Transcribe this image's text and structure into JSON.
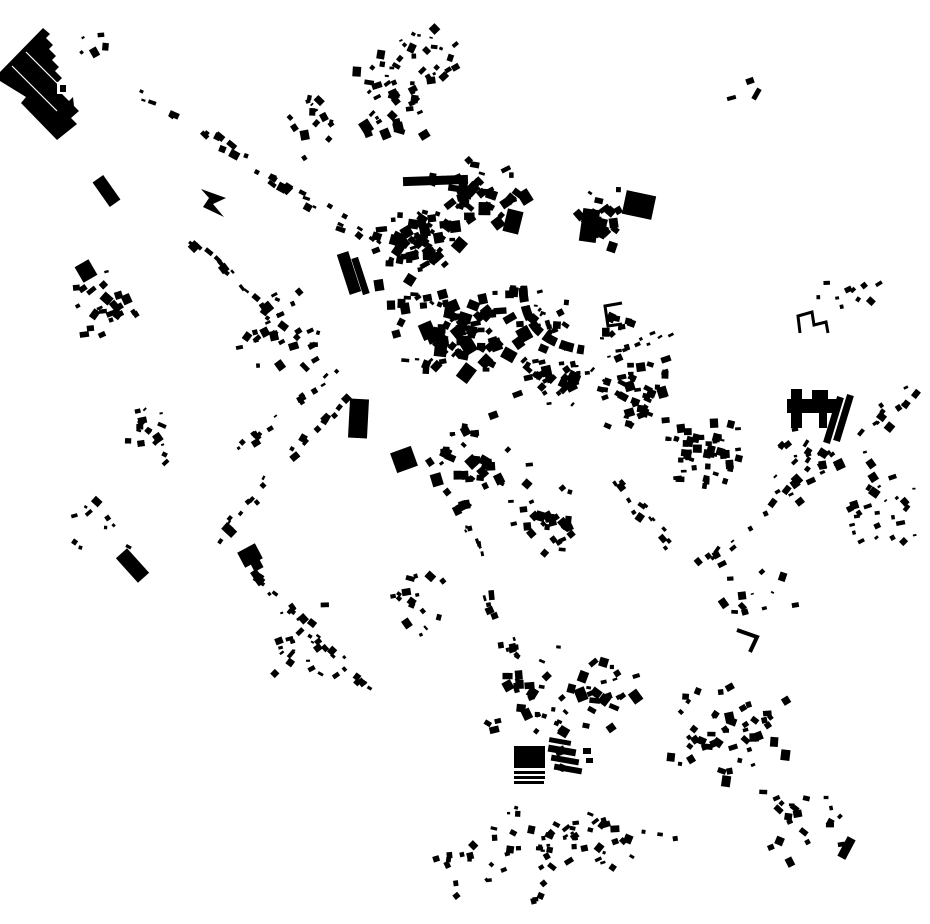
{
  "canvas": {
    "width": 930,
    "height": 924,
    "background": "#ffffff",
    "ink": "#000000"
  },
  "map": {
    "seed": 1337,
    "landmarks": {
      "factory": {
        "polygon": [
          [
            43,
            28
          ],
          [
            50,
            34
          ],
          [
            46,
            38
          ],
          [
            53,
            45
          ],
          [
            49,
            49
          ],
          [
            56,
            56
          ],
          [
            52,
            60
          ],
          [
            59,
            67
          ],
          [
            55,
            71
          ],
          [
            62,
            78
          ],
          [
            58,
            82
          ],
          [
            65,
            89
          ],
          [
            61,
            93
          ],
          [
            69,
            101
          ],
          [
            73,
            97
          ],
          [
            74,
            106
          ],
          [
            79,
            111
          ],
          [
            71,
            118
          ],
          [
            77,
            124
          ],
          [
            57,
            140
          ],
          [
            21,
            103
          ],
          [
            26,
            97
          ],
          [
            13,
            89
          ],
          [
            0,
            81
          ],
          [
            0,
            72
          ]
        ],
        "roof_lines": [
          [
            12,
            66,
            57,
            111
          ],
          [
            26,
            52,
            71,
            97
          ]
        ],
        "notch_white": [
          57,
          82,
          11,
          12
        ],
        "notch_black": [
          60,
          85,
          6,
          7
        ]
      },
      "arrow": [
        [
          201,
          189
        ],
        [
          226,
          198
        ],
        [
          213,
          204
        ],
        [
          224,
          217
        ],
        [
          203,
          207
        ],
        [
          209,
          198
        ]
      ],
      "crescent": {
        "path": "M 523 288 C 524 316 534 334 560 344 C 568 347 576 349 584 350",
        "stroke_width": 9,
        "dash": "14 4"
      },
      "h_complex": [
        [
          787,
          399,
          51,
          14,
          0
        ],
        [
          791,
          389,
          11,
          39,
          0
        ],
        [
          812,
          390,
          16,
          11,
          0
        ],
        [
          819,
          411,
          8,
          17,
          0
        ],
        [
          830,
          396,
          7,
          48,
          17
        ],
        [
          840,
          394,
          7,
          48,
          17
        ]
      ],
      "farm_block": [
        [
          514,
          746,
          31,
          22,
          0
        ],
        [
          514,
          771,
          31,
          3,
          0
        ],
        [
          514,
          776,
          31,
          3,
          0
        ],
        [
          514,
          781,
          30,
          3,
          0
        ],
        [
          548,
          747,
          28,
          7,
          10
        ],
        [
          551,
          757,
          28,
          6,
          10
        ],
        [
          554,
          766,
          28,
          6,
          10
        ],
        [
          549,
          739,
          22,
          5,
          10
        ],
        [
          583,
          748,
          8,
          6,
          0
        ],
        [
          586,
          758,
          7,
          5,
          0
        ]
      ],
      "brackets": [
        {
          "points": [
            [
              622,
              303
            ],
            [
              605,
              306
            ],
            [
              608,
              326
            ],
            [
              622,
              324
            ]
          ],
          "width": 3
        },
        {
          "points": [
            [
              800,
              333
            ],
            [
              798,
              316
            ],
            [
              812,
              312
            ],
            [
              814,
              325
            ],
            [
              826,
              322
            ],
            [
              828,
              333
            ]
          ],
          "width": 3
        },
        {
          "points": [
            [
              737,
              630
            ],
            [
              757,
              637
            ],
            [
              750,
              652
            ]
          ],
          "width": 4
        }
      ],
      "bars": [
        [
          403,
          176,
          65,
          9,
          -2
        ],
        [
          459,
          180,
          9,
          27,
          -2
        ],
        [
          343,
          252,
          12,
          42,
          -18
        ],
        [
          357,
          257,
          7,
          38,
          -18
        ],
        [
          349,
          399,
          19,
          39,
          3
        ],
        [
          125,
          549,
          15,
          33,
          -42
        ],
        [
          240,
          547,
          20,
          17,
          -28
        ],
        [
          252,
          561,
          10,
          9,
          -28
        ],
        [
          581,
          209,
          17,
          33,
          8
        ],
        [
          505,
          210,
          16,
          23,
          14
        ],
        [
          842,
          837,
          9,
          22,
          28
        ],
        [
          393,
          449,
          22,
          21,
          -20
        ],
        [
          624,
          193,
          30,
          24,
          12
        ],
        [
          78,
          262,
          16,
          18,
          -30
        ],
        [
          100,
          176,
          13,
          30,
          -35
        ],
        [
          746,
          78,
          8,
          6,
          -20
        ],
        [
          754,
          88,
          5,
          12,
          30
        ],
        [
          727,
          96,
          9,
          4,
          -15
        ]
      ]
    },
    "blob_clusters": [
      [
        420,
        240,
        55,
        45,
        60,
        4,
        13,
        0,
        50
      ],
      [
        470,
        190,
        55,
        35,
        40,
        4,
        12,
        0,
        50
      ],
      [
        460,
        330,
        75,
        45,
        75,
        4,
        14,
        0,
        50
      ],
      [
        555,
        375,
        45,
        35,
        40,
        4,
        11,
        0,
        50
      ],
      [
        640,
        390,
        45,
        45,
        45,
        4,
        10,
        5,
        30
      ],
      [
        700,
        455,
        50,
        45,
        50,
        4,
        9,
        5,
        14
      ],
      [
        595,
        220,
        30,
        40,
        22,
        4,
        11,
        0,
        50
      ],
      [
        390,
        100,
        45,
        55,
        30,
        4,
        11,
        0,
        50
      ],
      [
        310,
        120,
        30,
        40,
        16,
        3,
        9,
        0,
        50
      ],
      [
        430,
        40,
        40,
        25,
        14,
        3,
        10,
        0,
        50
      ],
      [
        105,
        300,
        35,
        40,
        24,
        4,
        10,
        -30,
        25
      ],
      [
        140,
        430,
        40,
        40,
        18,
        3,
        9,
        0,
        50
      ],
      [
        90,
        520,
        45,
        35,
        10,
        3,
        8,
        0,
        50
      ],
      [
        280,
        330,
        50,
        45,
        26,
        3,
        10,
        0,
        50
      ],
      [
        548,
        318,
        26,
        24,
        14,
        3,
        8,
        0,
        50
      ],
      [
        470,
        460,
        60,
        50,
        35,
        4,
        11,
        0,
        50
      ],
      [
        540,
        520,
        50,
        40,
        28,
        4,
        10,
        0,
        50
      ],
      [
        560,
        700,
        80,
        70,
        55,
        4,
        11,
        0,
        45
      ],
      [
        730,
        740,
        70,
        70,
        50,
        4,
        10,
        0,
        45
      ],
      [
        560,
        830,
        100,
        40,
        40,
        3,
        9,
        0,
        45
      ],
      [
        880,
        500,
        45,
        60,
        28,
        3,
        9,
        -30,
        30
      ],
      [
        805,
        450,
        35,
        30,
        16,
        3,
        8,
        -30,
        30
      ],
      [
        760,
        590,
        50,
        40,
        12,
        3,
        8,
        0,
        50
      ],
      [
        800,
        820,
        50,
        45,
        20,
        3,
        9,
        0,
        50
      ],
      [
        500,
        880,
        60,
        22,
        12,
        3,
        7,
        0,
        50
      ],
      [
        92,
        42,
        16,
        12,
        5,
        3,
        8,
        -20,
        30
      ],
      [
        610,
        320,
        25,
        20,
        10,
        3,
        8,
        0,
        50
      ],
      [
        850,
        300,
        45,
        25,
        10,
        3,
        8,
        -30,
        30
      ],
      [
        300,
        640,
        45,
        45,
        20,
        3,
        9,
        0,
        50
      ],
      [
        420,
        600,
        35,
        40,
        16,
        3,
        9,
        0,
        50
      ]
    ],
    "line_clusters": [
      [
        100,
        70,
        390,
        250,
        34,
        3,
        10,
        10,
        15
      ],
      [
        190,
        240,
        300,
        345,
        18,
        4,
        10,
        7,
        12
      ],
      [
        345,
        362,
        222,
        458,
        16,
        3,
        9,
        7,
        12
      ],
      [
        345,
        390,
        205,
        545,
        22,
        3,
        9,
        8,
        14
      ],
      [
        240,
        560,
        380,
        700,
        26,
        3,
        9,
        9,
        14
      ],
      [
        455,
        495,
        520,
        690,
        26,
        3,
        10,
        10,
        16
      ],
      [
        915,
        385,
        700,
        565,
        36,
        3,
        10,
        12,
        16
      ],
      [
        430,
        858,
        700,
        830,
        18,
        3,
        8,
        8,
        16
      ],
      [
        610,
        480,
        690,
        565,
        14,
        3,
        8,
        8,
        14
      ],
      [
        355,
        130,
        450,
        60,
        14,
        3,
        9,
        8,
        16
      ],
      [
        590,
        360,
        670,
        330,
        10,
        3,
        8,
        6,
        14
      ],
      [
        380,
        300,
        540,
        285,
        16,
        4,
        10,
        6,
        12
      ]
    ]
  }
}
